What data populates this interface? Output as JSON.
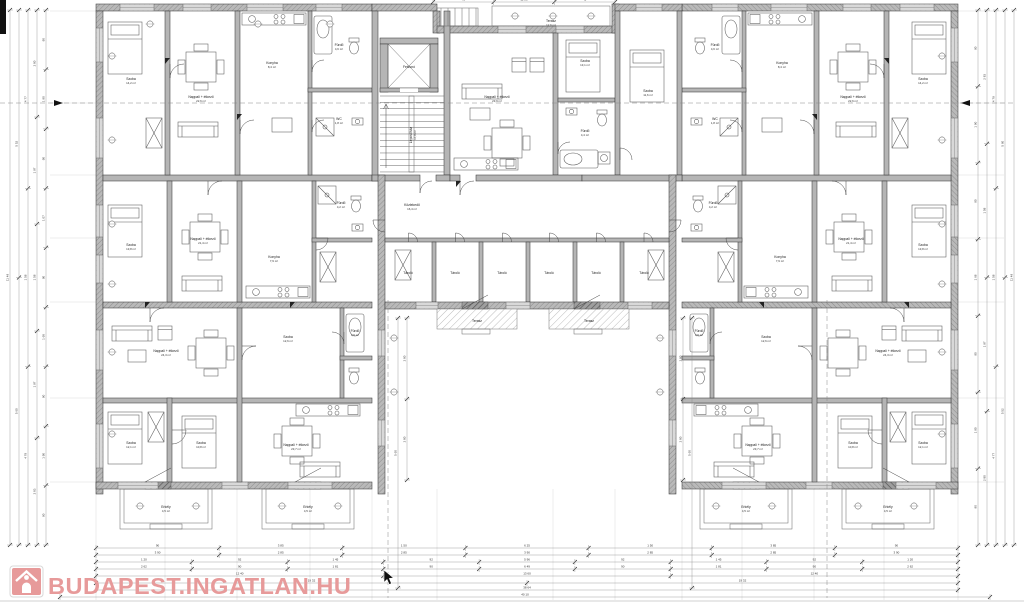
{
  "watermark": {
    "text": "BUDAPEST.INGATLAN.HU",
    "color": "#E79A9A",
    "icon": "house-icon"
  },
  "plan": {
    "room_labels": [
      {
        "t": "Szoba",
        "a": "14,2 m²",
        "x": 131,
        "y": 80
      },
      {
        "t": "Nappali + étkező",
        "a": "22,6 m²",
        "x": 201,
        "y": 98
      },
      {
        "t": "Konyha",
        "a": "8,4 m²",
        "x": 272,
        "y": 64
      },
      {
        "t": "Fürdő",
        "a": "4,6 m²",
        "x": 339,
        "y": 46
      },
      {
        "t": "WC",
        "a": "1,8 m²",
        "x": 339,
        "y": 120
      },
      {
        "t": "Szoba",
        "a": "13,8 m²",
        "x": 131,
        "y": 246
      },
      {
        "t": "Nappali + étkező",
        "a": "21,4 m²",
        "x": 203,
        "y": 240
      },
      {
        "t": "Konyha",
        "a": "7,9 m²",
        "x": 274,
        "y": 258
      },
      {
        "t": "Fürdő",
        "a": "4,2 m²",
        "x": 341,
        "y": 204
      },
      {
        "t": "Nappali + étkező",
        "a": "24,3 m²",
        "x": 166,
        "y": 352
      },
      {
        "t": "Szoba",
        "a": "12,6 m²",
        "x": 288,
        "y": 338
      },
      {
        "t": "Fürdő",
        "a": "3,9 m²",
        "x": 355,
        "y": 332
      },
      {
        "t": "Szoba",
        "a": "12,1 m²",
        "x": 131,
        "y": 444
      },
      {
        "t": "Szoba",
        "a": "10,8 m²",
        "x": 201,
        "y": 444
      },
      {
        "t": "Nappali + étkező",
        "a": "23,7 m²",
        "x": 296,
        "y": 446
      },
      {
        "t": "Erkély",
        "a": "4,5 m²",
        "x": 166,
        "y": 508
      },
      {
        "t": "Erkély",
        "a": "4,5 m²",
        "x": 308,
        "y": 508
      },
      {
        "t": "Erkély",
        "a": "4,5 m²",
        "x": 746,
        "y": 508
      },
      {
        "t": "Erkély",
        "a": "4,5 m²",
        "x": 888,
        "y": 508
      },
      {
        "t": "Felvonó",
        "a": "",
        "x": 409,
        "y": 68
      },
      {
        "t": "Lépcsőház",
        "a": "17,8 m²",
        "x": 412,
        "y": 135,
        "r": -90
      },
      {
        "t": "Közlekedő",
        "a": "16,4 m²",
        "x": 412,
        "y": 206
      },
      {
        "t": "Nappali + étkező",
        "a": "23,9 m²",
        "x": 497,
        "y": 98
      },
      {
        "t": "Szoba",
        "a": "13,1 m²",
        "x": 585,
        "y": 62
      },
      {
        "t": "Fürdő",
        "a": "4,4 m²",
        "x": 585,
        "y": 132
      },
      {
        "t": "Szoba",
        "a": "11,6 m²",
        "x": 648,
        "y": 92
      },
      {
        "t": "Terasz",
        "a": "12,6 m²",
        "x": 551,
        "y": 22
      },
      {
        "t": "Tároló",
        "a": "",
        "x": 408,
        "y": 274
      },
      {
        "t": "Tároló",
        "a": "",
        "x": 455,
        "y": 274
      },
      {
        "t": "Tároló",
        "a": "",
        "x": 502,
        "y": 274
      },
      {
        "t": "Tároló",
        "a": "",
        "x": 549,
        "y": 274
      },
      {
        "t": "Tároló",
        "a": "",
        "x": 596,
        "y": 274
      },
      {
        "t": "Tároló",
        "a": "",
        "x": 644,
        "y": 274
      },
      {
        "t": "Terasz",
        "a": "",
        "x": 477,
        "y": 322
      },
      {
        "t": "Terasz",
        "a": "",
        "x": 589,
        "y": 322
      },
      {
        "t": "Szoba",
        "a": "14,2 m²",
        "x": 923,
        "y": 80
      },
      {
        "t": "Nappali + étkező",
        "a": "22,6 m²",
        "x": 853,
        "y": 98
      },
      {
        "t": "Konyha",
        "a": "8,4 m²",
        "x": 782,
        "y": 64
      },
      {
        "t": "Fürdő",
        "a": "4,6 m²",
        "x": 715,
        "y": 46
      },
      {
        "t": "WC",
        "a": "1,8 m²",
        "x": 715,
        "y": 120
      },
      {
        "t": "Szoba",
        "a": "13,8 m²",
        "x": 923,
        "y": 246
      },
      {
        "t": "Nappali + étkező",
        "a": "21,4 m²",
        "x": 851,
        "y": 240
      },
      {
        "t": "Konyha",
        "a": "7,9 m²",
        "x": 780,
        "y": 258
      },
      {
        "t": "Fürdő",
        "a": "4,2 m²",
        "x": 713,
        "y": 204
      },
      {
        "t": "Nappali + étkező",
        "a": "24,3 m²",
        "x": 888,
        "y": 352
      },
      {
        "t": "Szoba",
        "a": "12,6 m²",
        "x": 766,
        "y": 338
      },
      {
        "t": "Fürdő",
        "a": "3,9 m²",
        "x": 699,
        "y": 332
      },
      {
        "t": "Szoba",
        "a": "12,1 m²",
        "x": 923,
        "y": 444
      },
      {
        "t": "Szoba",
        "a": "10,8 m²",
        "x": 853,
        "y": 444
      },
      {
        "t": "Nappali + étkező",
        "a": "23,7 m²",
        "x": 758,
        "y": 446
      }
    ],
    "dim_chains": [
      {
        "o": "h",
        "a": 548,
        "s": 96,
        "e": 958,
        "v": [
          "90",
          "3 85",
          "1 50",
          "6 25",
          "1 50",
          "3 85",
          "90"
        ]
      },
      {
        "o": "h",
        "a": 555,
        "s": 96,
        "e": 958,
        "v": [
          "3 90",
          "2 85",
          "2 85",
          "3 90",
          "2 85",
          "2 85",
          "3 90"
        ]
      },
      {
        "o": "h",
        "a": 562,
        "s": 96,
        "e": 958,
        "v": [
          "1 20",
          "92",
          "1 45",
          "92",
          "5 96",
          "92",
          "1 45",
          "92",
          "1 20"
        ]
      },
      {
        "o": "h",
        "a": 569,
        "s": 96,
        "e": 958,
        "v": [
          "2 62",
          "90",
          "1 81",
          "90",
          "6 49",
          "90",
          "1 81",
          "90",
          "2 62"
        ]
      },
      {
        "o": "h",
        "a": 576,
        "s": 96,
        "e": 958,
        "v": [
          "12 40",
          "13 60",
          "12 40"
        ]
      },
      {
        "o": "h",
        "a": 583,
        "s": 96,
        "e": 958,
        "v": [
          "19 32",
          "19 32"
        ]
      },
      {
        "o": "h",
        "a": 590,
        "s": 96,
        "e": 958,
        "v": [
          "38 64"
        ]
      },
      {
        "o": "h",
        "a": 597,
        "s": 60,
        "e": 990,
        "v": [
          "40 10"
        ]
      },
      {
        "o": "h",
        "a": 2,
        "s": 433,
        "e": 615,
        "v": [
          "45",
          "11 80",
          "45"
        ]
      },
      {
        "o": "v",
        "a": 10,
        "s": 10,
        "e": 545,
        "v": [
          "11 49"
        ]
      },
      {
        "o": "v",
        "a": 19,
        "s": 10,
        "e": 545,
        "v": [
          "5 52",
          "5 60"
        ]
      },
      {
        "o": "v",
        "a": 28,
        "s": 10,
        "e": 545,
        "v": [
          "4 77",
          "1 58",
          "4 79"
        ]
      },
      {
        "o": "v",
        "a": 37,
        "s": 10,
        "e": 545,
        "v": [
          "2 80",
          "1 97",
          "1 58",
          "1 97",
          "2 83"
        ]
      },
      {
        "o": "v",
        "a": 46,
        "s": 10,
        "e": 545,
        "v": [
          "90",
          "1 90",
          "90",
          "1 07",
          "90",
          "1 68",
          "90",
          "1 90",
          "90"
        ]
      },
      {
        "o": "v",
        "a": 1014,
        "s": 10,
        "e": 545,
        "v": [
          "11 49"
        ]
      },
      {
        "o": "v",
        "a": 1005,
        "s": 10,
        "e": 545,
        "v": [
          "5 60",
          "5 52"
        ]
      },
      {
        "o": "v",
        "a": 996,
        "s": 10,
        "e": 545,
        "v": [
          "4 79",
          "1 58",
          "4 77"
        ]
      },
      {
        "o": "v",
        "a": 987,
        "s": 10,
        "e": 545,
        "v": [
          "2 83",
          "1 58",
          "1 97",
          "2 80"
        ]
      },
      {
        "o": "v",
        "a": 978,
        "s": 10,
        "e": 545,
        "v": [
          "90",
          "1 90",
          "90",
          "1 68",
          "90",
          "1 90",
          "90"
        ]
      },
      {
        "o": "v",
        "a": 398,
        "s": 318,
        "e": 588,
        "v": [
          "5 60"
        ]
      },
      {
        "o": "v",
        "a": 407,
        "s": 318,
        "e": 480,
        "v": [
          "2 80",
          "2 80"
        ]
      },
      {
        "o": "v",
        "a": 683,
        "s": 318,
        "e": 480,
        "v": [
          "2 80",
          "2 80"
        ]
      },
      {
        "o": "v",
        "a": 692,
        "s": 318,
        "e": 588,
        "v": [
          "5 60"
        ]
      }
    ],
    "tags": [
      [
        112,
        56
      ],
      [
        112,
        140
      ],
      [
        112,
        224
      ],
      [
        112,
        284
      ],
      [
        112,
        352
      ],
      [
        112,
        434
      ],
      [
        150,
        24
      ],
      [
        258,
        24
      ],
      [
        330,
        24
      ],
      [
        515,
        16
      ],
      [
        553,
        16
      ],
      [
        591,
        16
      ],
      [
        140,
        506
      ],
      [
        196,
        506
      ],
      [
        282,
        506
      ],
      [
        338,
        506
      ],
      [
        716,
        506
      ],
      [
        772,
        506
      ],
      [
        858,
        506
      ],
      [
        914,
        506
      ],
      [
        942,
        56
      ],
      [
        942,
        140
      ],
      [
        942,
        224
      ],
      [
        942,
        284
      ],
      [
        942,
        352
      ],
      [
        942,
        434
      ],
      [
        394,
        338
      ],
      [
        394,
        392
      ],
      [
        660,
        338
      ],
      [
        660,
        392
      ]
    ]
  }
}
